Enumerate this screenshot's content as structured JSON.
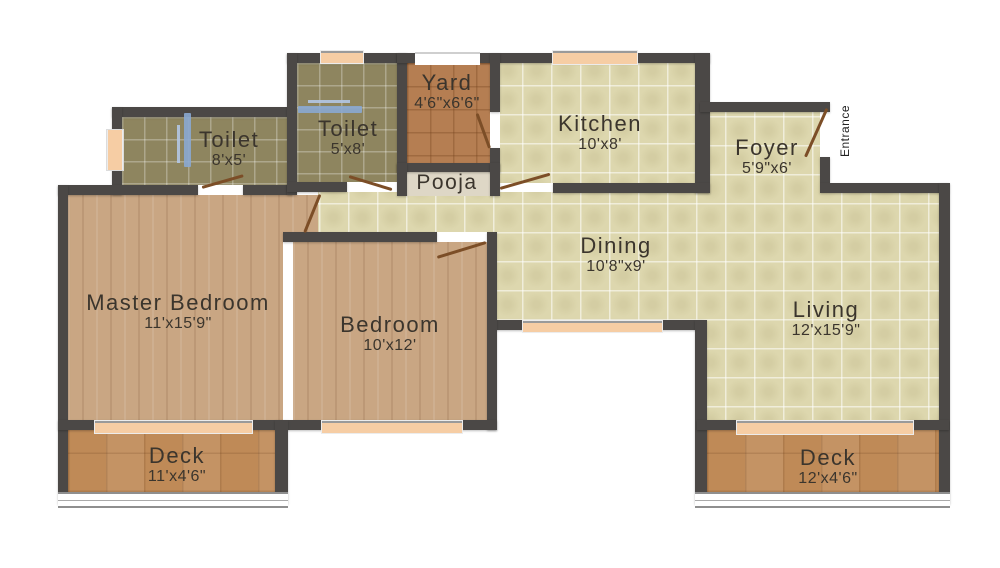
{
  "plan": {
    "title": "2BHK apartment floor plan",
    "rooms": [
      {
        "name": "Toilet",
        "dims": "8'x5'"
      },
      {
        "name": "Toilet",
        "dims": "5'x8'"
      },
      {
        "name": "Yard",
        "dims": "4'6\"x6'6\""
      },
      {
        "name": "Pooja",
        "dims": ""
      },
      {
        "name": "Kitchen",
        "dims": "10'x8'"
      },
      {
        "name": "Foyer",
        "dims": "5'9\"x6'"
      },
      {
        "name": "Dining",
        "dims": "10'8\"x9'"
      },
      {
        "name": "Living",
        "dims": "12'x15'9\""
      },
      {
        "name": "Master Bedroom",
        "dims": "11'x15'9\""
      },
      {
        "name": "Bedroom",
        "dims": "10'x12'"
      },
      {
        "name": "Deck",
        "dims": "11'x4'6\""
      },
      {
        "name": "Deck",
        "dims": "12'x4'6\""
      }
    ],
    "entrance_label": "Entrance",
    "colors": {
      "wall": "#4b4846",
      "floor_tile_cream": "#ddd7ae",
      "floor_tile_olive": "#8e855f",
      "floor_tile_terracotta": "#b57e52",
      "floor_wood": "#c9a683",
      "floor_deck": "#bf8a57",
      "floor_pooja": "#ded7c6",
      "window_sill": "#f6cda4",
      "door_leaf": "#7c4e27",
      "bath_fixture": "#8aa8d2",
      "label_text": "#3b352d",
      "background": "#ffffff"
    }
  }
}
